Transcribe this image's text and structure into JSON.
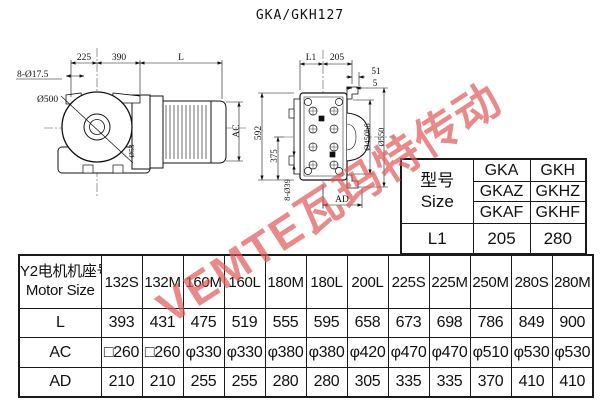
{
  "title": "GKA/GKH127",
  "watermark": {
    "text": "VEMTE瓦玛特传动",
    "color": "#e05a5a"
  },
  "front": {
    "top_dims": [
      "225",
      "390",
      "L"
    ],
    "bolt_label": "8-Ø17.5",
    "diameter_label": "Ø500",
    "ac_label": "AC",
    "shaft_label": "Ø53"
  },
  "side": {
    "top_dims": [
      "L1",
      "205"
    ],
    "small_dims": [
      "51",
      "5"
    ],
    "left_dims": [
      "592",
      "375"
    ],
    "bolt_label": "8-Ø39",
    "flange_labels": [
      "Ø450h6",
      "Ø550"
    ],
    "ad_label": "AD"
  },
  "size_table": {
    "header_cn": "型号",
    "header_en": "Size",
    "col_a": [
      "GKA",
      "GKAZ",
      "GKAF"
    ],
    "col_b": [
      "GKH",
      "GKHZ",
      "GKHF"
    ],
    "l1_label": "L1",
    "l1_values": [
      "205",
      "280"
    ]
  },
  "motor_table": {
    "header_cn": "Y2电机机座号",
    "header_en": "Motor Size",
    "sizes": [
      "132S",
      "132M",
      "160M",
      "160L",
      "180M",
      "180L",
      "200L",
      "225S",
      "225M",
      "250M",
      "280S",
      "280M"
    ],
    "rows": [
      {
        "label": "L",
        "values": [
          "393",
          "431",
          "475",
          "519",
          "555",
          "595",
          "658",
          "673",
          "698",
          "786",
          "849",
          "900"
        ]
      },
      {
        "label": "AC",
        "values": [
          "□260",
          "□260",
          "φ330",
          "φ330",
          "φ380",
          "φ380",
          "φ420",
          "φ470",
          "φ470",
          "φ510",
          "φ530",
          "φ530"
        ]
      },
      {
        "label": "AD",
        "values": [
          "210",
          "210",
          "255",
          "255",
          "280",
          "280",
          "305",
          "335",
          "335",
          "370",
          "410",
          "410"
        ]
      }
    ]
  }
}
